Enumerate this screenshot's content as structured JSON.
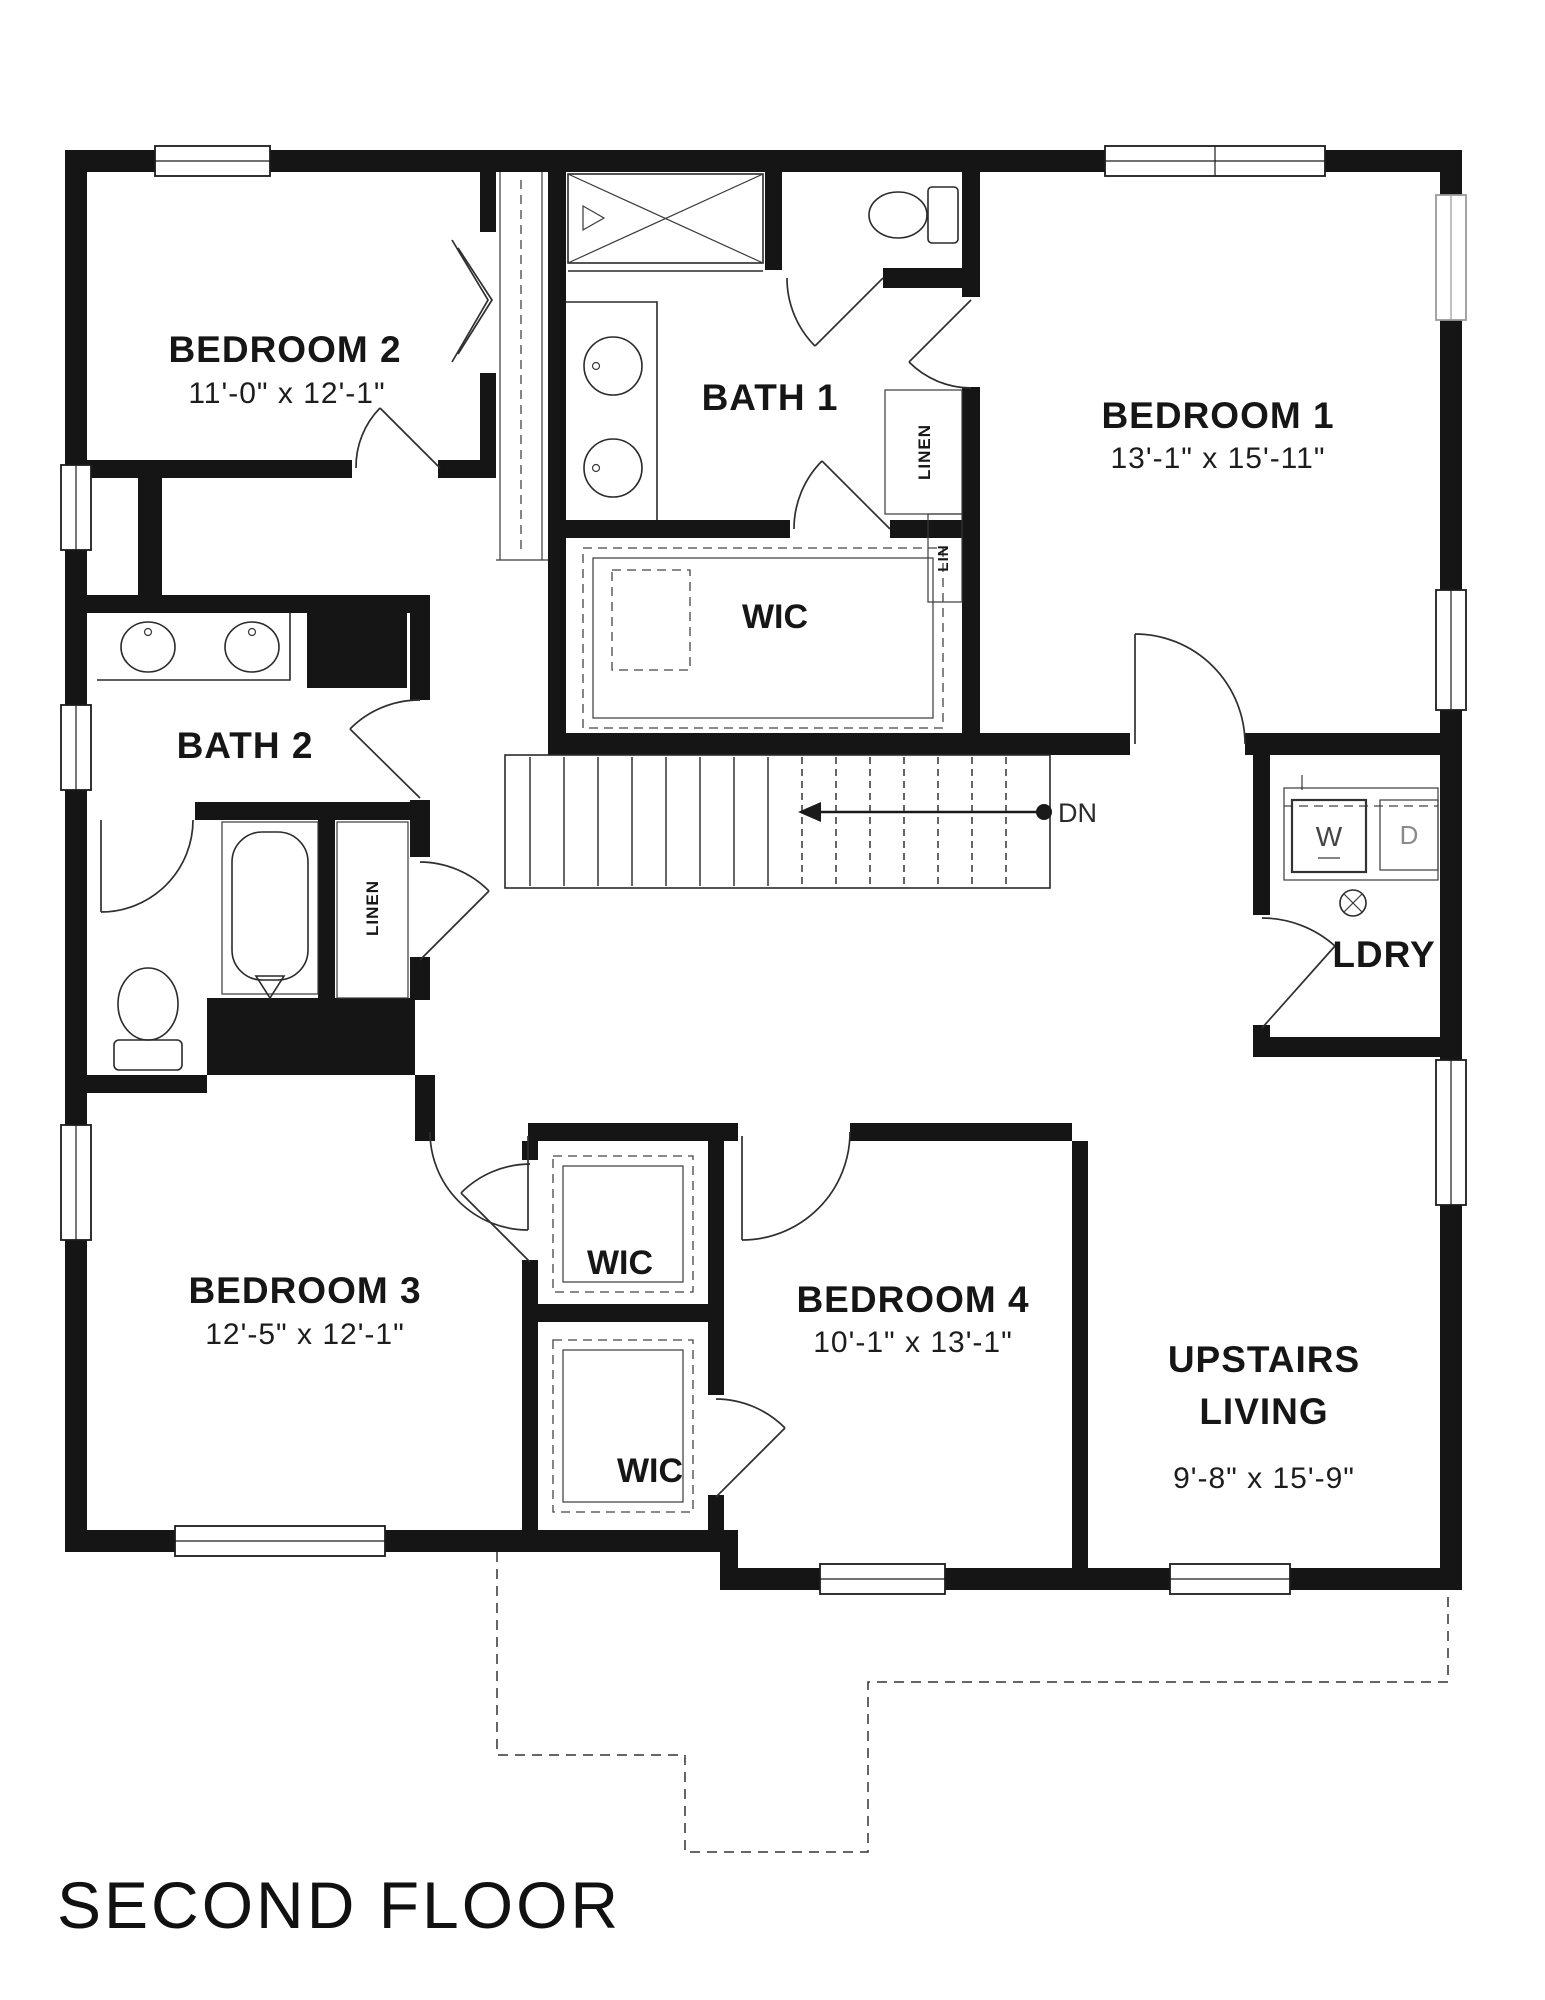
{
  "plan_title": "SECOND FLOOR",
  "colors": {
    "ink": "#151515",
    "paper": "#ffffff"
  },
  "rooms": {
    "bedroom2": {
      "name": "BEDROOM 2",
      "dims": "11'-0\" x 12'-1\""
    },
    "bath1": {
      "name": "BATH 1"
    },
    "bedroom1": {
      "name": "BEDROOM 1",
      "dims": "13'-1\" x 15'-11\""
    },
    "wic_master": {
      "name": "WIC"
    },
    "bath2": {
      "name": "BATH 2"
    },
    "ldry": {
      "name": "LDRY"
    },
    "bedroom3": {
      "name": "BEDROOM 3",
      "dims": "12'-5\" x 12'-1\""
    },
    "wic_bedroom3": {
      "name": "WIC"
    },
    "wic_bedroom4": {
      "name": "WIC"
    },
    "bedroom4": {
      "name": "BEDROOM 4",
      "dims": "10'-1\" x 13'-1\""
    },
    "upstairs_living": {
      "line1": "UPSTAIRS",
      "line2": "LIVING",
      "dims": "9'-8\" x 15'-9\""
    }
  },
  "closets": {
    "linen_bath1": "LINEN",
    "lin_bath1": "LIN",
    "linen_bath2": "LINEN"
  },
  "stairs": {
    "down_label": "DN"
  },
  "appliances": {
    "washer": "W",
    "dryer": "D"
  }
}
